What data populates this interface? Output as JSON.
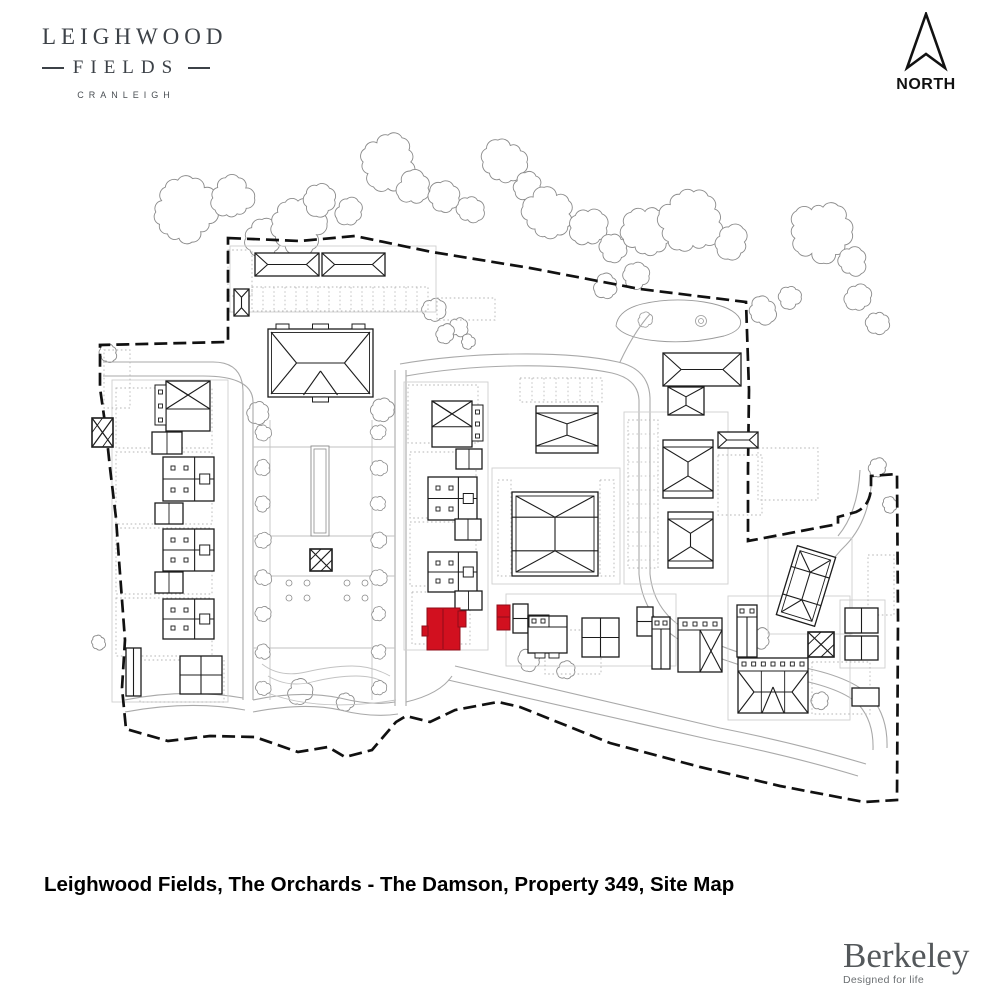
{
  "header": {
    "logo": {
      "line1": "LEIGHWOOD",
      "line2": "FIELDS",
      "line3": "CRANLEIGH"
    },
    "north_label": "NORTH"
  },
  "footer": {
    "caption": "Leighwood Fields, The Orchards - The Damson, Property 349, Site Map",
    "brand": "Berkeley",
    "brand_tagline": "Designed for life"
  },
  "colors": {
    "highlight": "#d2101f",
    "highlight_edge": "#8f0d18",
    "line": "#1c1c1c",
    "road": "#a9a9a9",
    "dots": "#b5b5b5",
    "plot": "#cfcfcf",
    "tree": "#8a8a8a",
    "boundary": "#111111"
  },
  "site_plan": {
    "boundary": "M228,238 L300,241 L355,236 L432,252 L530,268 L640,289 L746,302 L749,390 L748,468 L748,541 L838,524 L838,517 L856,512 Q870,506 871,488 L871,476 L897,474 L898,620 L897,800 L864,802 L780,786 L700,767 L610,743 L520,707 L498,702 L455,710 L430,722 L406,716 L396,722 L372,750 L345,757 L328,747 L298,752 L255,737 L210,736 L168,741 L126,729 L122,688 L125,640 L119,560 L116,518 L110,468 L106,430 L100,388 L100,345 L228,342 Z",
    "roads": [
      "M103,362 H213 Q243,362 243,392 V700",
      "M103,376 H203 Q253,376 253,402 V700",
      "M395,370 V706",
      "M406,370 V706",
      "M400,364 C470,352 565,350 618,362 Q649,369 650,398 V574",
      "M406,376 C475,364 560,362 612,373 Q638,379 639,400 V574",
      "M650,574 Q654,614 692,633 Q742,658 795,666 Q852,676 872,698 Q888,718 887,748",
      "M639,574 Q643,620 686,644 Q738,668 790,678 Q843,688 859,705 Q874,722 873,750",
      "M125,700 Q185,688 243,698",
      "M125,712 Q190,700 245,710",
      "M253,700 Q300,690 340,698 Q372,706 395,702",
      "M253,712 Q305,702 340,710 Q372,718 398,714",
      "M406,702 Q440,694 452,676",
      "M455,666 Q600,700 720,728 Q800,744 866,764",
      "M448,680 Q595,714 712,740 Q792,756 858,776",
      "M872,476 Q870,520 846,545 Q824,566 820,590",
      "M860,470 Q858,512 838,536",
      "M620,362 Q634,332 650,314"
    ],
    "trees": [
      [
        185,
        212,
        30
      ],
      [
        232,
        198,
        20
      ],
      [
        262,
        238,
        16
      ],
      [
        298,
        224,
        26
      ],
      [
        320,
        200,
        15
      ],
      [
        350,
        212,
        13
      ],
      [
        388,
        162,
        26
      ],
      [
        414,
        188,
        15
      ],
      [
        444,
        198,
        14
      ],
      [
        470,
        210,
        12
      ],
      [
        505,
        162,
        20
      ],
      [
        528,
        186,
        13
      ],
      [
        548,
        214,
        24
      ],
      [
        588,
        228,
        17
      ],
      [
        614,
        248,
        13
      ],
      [
        648,
        232,
        24
      ],
      [
        690,
        222,
        28
      ],
      [
        732,
        242,
        15
      ],
      [
        762,
        310,
        13
      ],
      [
        790,
        297,
        11
      ],
      [
        820,
        232,
        28
      ],
      [
        852,
        262,
        13
      ],
      [
        858,
        298,
        13
      ],
      [
        878,
        322,
        10
      ],
      [
        606,
        286,
        11
      ],
      [
        636,
        276,
        11
      ],
      [
        433,
        310,
        11
      ],
      [
        458,
        327,
        9
      ],
      [
        108,
        353,
        8
      ],
      [
        258,
        412,
        10
      ],
      [
        383,
        410,
        10
      ],
      [
        300,
        692,
        11
      ],
      [
        345,
        701,
        8
      ],
      [
        98,
        642,
        7
      ],
      [
        530,
        660,
        10
      ],
      [
        566,
        670,
        8
      ],
      [
        760,
        638,
        9
      ],
      [
        820,
        701,
        8
      ],
      [
        445,
        334,
        9
      ],
      [
        468,
        342,
        7
      ],
      [
        878,
        468,
        8
      ],
      [
        890,
        505,
        7
      ]
    ],
    "pond": {
      "outer": "M616,326 Q618,310 642,304 Q672,297 704,302 Q734,307 740,319 Q744,330 724,336 Q690,344 658,341 Q624,338 616,326 Z",
      "circles": [
        [
          701,
          321,
          2.5
        ],
        [
          701,
          321,
          5.5
        ]
      ],
      "blob": [
        645,
        320,
        7
      ]
    },
    "plots": [
      [
        112,
        380,
        116,
        322
      ],
      [
        404,
        382,
        84,
        268
      ],
      [
        492,
        468,
        128,
        116
      ],
      [
        624,
        412,
        104,
        172
      ],
      [
        506,
        594,
        170,
        72
      ],
      [
        728,
        596,
        122,
        124
      ],
      [
        230,
        246,
        206,
        66
      ],
      [
        768,
        538,
        84,
        96
      ],
      [
        840,
        600,
        45,
        68
      ]
    ],
    "dotted_areas": [
      {
        "x": 116,
        "y": 388,
        "w": 96,
        "h": 60
      },
      {
        "x": 116,
        "y": 452,
        "w": 96,
        "h": 72
      },
      {
        "x": 116,
        "y": 528,
        "w": 96,
        "h": 66
      },
      {
        "x": 116,
        "y": 598,
        "w": 96,
        "h": 58
      },
      {
        "x": 140,
        "y": 660,
        "w": 84,
        "h": 42
      },
      {
        "x": 252,
        "y": 287,
        "w": 176,
        "h": 24,
        "bays": 11
      },
      {
        "x": 408,
        "y": 385,
        "w": 70,
        "h": 58
      },
      {
        "x": 410,
        "y": 452,
        "w": 66,
        "h": 66
      },
      {
        "x": 410,
        "y": 522,
        "w": 66,
        "h": 64
      },
      {
        "x": 412,
        "y": 592,
        "w": 58,
        "h": 52
      },
      {
        "x": 520,
        "y": 378,
        "w": 82,
        "h": 24,
        "bays": 12
      },
      {
        "x": 498,
        "y": 480,
        "w": 13,
        "h": 96
      },
      {
        "x": 600,
        "y": 480,
        "w": 14,
        "h": 96
      },
      {
        "x": 628,
        "y": 420,
        "w": 30,
        "h": 148,
        "baysH": 14
      },
      {
        "x": 545,
        "y": 630,
        "w": 56,
        "h": 44
      },
      {
        "x": 718,
        "y": 455,
        "w": 44,
        "h": 60
      },
      {
        "x": 758,
        "y": 448,
        "w": 60,
        "h": 52
      },
      {
        "x": 812,
        "y": 662,
        "w": 58,
        "h": 52
      },
      {
        "x": 868,
        "y": 555,
        "w": 26,
        "h": 60
      },
      {
        "x": 228,
        "y": 250,
        "w": 24,
        "h": 46
      },
      {
        "x": 104,
        "y": 350,
        "w": 26,
        "h": 58
      },
      {
        "x": 437,
        "y": 298,
        "w": 58,
        "h": 22
      }
    ],
    "garden": {
      "avenue_x": [
        263,
        379
      ],
      "avenue_y": [
        432,
        468,
        504,
        540,
        578,
        614,
        652,
        688
      ],
      "avenue_r": 7,
      "strip_outer": [
        311,
        446,
        18,
        90
      ],
      "strip_inner": [
        314,
        449,
        12,
        84
      ],
      "parterre": [
        [
          289,
          583
        ],
        [
          307,
          583
        ],
        [
          347,
          583
        ],
        [
          365,
          583
        ],
        [
          289,
          598
        ],
        [
          307,
          598
        ],
        [
          347,
          598
        ],
        [
          365,
          598
        ]
      ],
      "paths": [
        "M270,420 V700",
        "M372,420 V700",
        "M253,447 H395",
        "M253,536 H395",
        "M253,576 H395",
        "M253,648 H395",
        "M262,664 q18,14 44,8 t46,-6 t38,10",
        "M268,676 q20,12 44,6 t44,-6 t30,8",
        "M256,688 Q310,714 396,700"
      ]
    },
    "buildings": [
      {
        "t": "hipH",
        "x": 255,
        "y": 253,
        "w": 64,
        "h": 23
      },
      {
        "t": "hipH",
        "x": 322,
        "y": 253,
        "w": 63,
        "h": 23
      },
      {
        "t": "hipV",
        "x": 234,
        "y": 289,
        "w": 15,
        "h": 27
      },
      {
        "t": "manor",
        "x": 268,
        "y": 329,
        "w": 105,
        "h": 68
      },
      {
        "t": "hipH",
        "x": 663,
        "y": 353,
        "w": 78,
        "h": 33
      },
      {
        "t": "hipV",
        "x": 668,
        "y": 387,
        "w": 36,
        "h": 28
      },
      {
        "t": "xtop",
        "x": 166,
        "y": 381,
        "w": 44,
        "h": 50,
        "side": "l"
      },
      {
        "t": "terrace",
        "x": 163,
        "y": 457,
        "w": 51,
        "h": 44
      },
      {
        "t": "terrace",
        "x": 163,
        "y": 529,
        "w": 51,
        "h": 42
      },
      {
        "t": "terrace",
        "x": 163,
        "y": 599,
        "w": 51,
        "h": 40
      },
      {
        "t": "grid2",
        "x": 180,
        "y": 656,
        "w": 42,
        "h": 38
      },
      {
        "t": "plain",
        "x": 126,
        "y": 648,
        "w": 15,
        "h": 48,
        "vline": true
      },
      {
        "t": "garage",
        "x": 152,
        "y": 432,
        "w": 30,
        "h": 22
      },
      {
        "t": "garage",
        "x": 155,
        "y": 503,
        "w": 28,
        "h": 21
      },
      {
        "t": "garage",
        "x": 155,
        "y": 572,
        "w": 28,
        "h": 21
      },
      {
        "t": "xtop",
        "x": 432,
        "y": 401,
        "w": 40,
        "h": 46,
        "side": "r"
      },
      {
        "t": "terrace",
        "x": 428,
        "y": 477,
        "w": 49,
        "h": 43
      },
      {
        "t": "terrace",
        "x": 428,
        "y": 552,
        "w": 49,
        "h": 40
      },
      {
        "t": "garage",
        "x": 456,
        "y": 449,
        "w": 26,
        "h": 20
      },
      {
        "t": "garage",
        "x": 455,
        "y": 519,
        "w": 26,
        "h": 21
      },
      {
        "t": "garage",
        "x": 455,
        "y": 591,
        "w": 27,
        "h": 19
      },
      {
        "t": "apt",
        "x": 536,
        "y": 406,
        "w": 62,
        "h": 47
      },
      {
        "t": "court",
        "x": 512,
        "y": 492,
        "w": 86,
        "h": 84
      },
      {
        "t": "plain",
        "x": 513,
        "y": 604,
        "w": 15,
        "h": 29,
        "hline": 0.5
      },
      {
        "t": "shopA",
        "x": 528,
        "y": 616,
        "w": 39,
        "h": 37
      },
      {
        "t": "grid2",
        "x": 582,
        "y": 618,
        "w": 37,
        "h": 39
      },
      {
        "t": "plain",
        "x": 637,
        "y": 607,
        "w": 16,
        "h": 29,
        "hline": 0.5
      },
      {
        "t": "tallD",
        "x": 652,
        "y": 617,
        "w": 18,
        "h": 52
      },
      {
        "t": "semiX",
        "x": 678,
        "y": 618,
        "w": 44,
        "h": 54
      },
      {
        "t": "apt",
        "x": 663,
        "y": 440,
        "w": 50,
        "h": 58
      },
      {
        "t": "apt",
        "x": 668,
        "y": 512,
        "w": 45,
        "h": 56
      },
      {
        "t": "hipH",
        "x": 718,
        "y": 432,
        "w": 40,
        "h": 16
      },
      {
        "t": "court",
        "x": 786,
        "y": 550,
        "w": 40,
        "h": 72,
        "rot": 17
      },
      {
        "t": "hatch",
        "x": 92,
        "y": 418,
        "w": 21,
        "h": 29
      },
      {
        "t": "hatch",
        "x": 310,
        "y": 549,
        "w": 22,
        "h": 22
      },
      {
        "t": "hatch",
        "x": 808,
        "y": 632,
        "w": 26,
        "h": 25
      },
      {
        "t": "tallD",
        "x": 737,
        "y": 605,
        "w": 20,
        "h": 52
      },
      {
        "t": "terraceHip",
        "x": 738,
        "y": 658,
        "w": 70,
        "h": 55
      },
      {
        "t": "plain",
        "x": 845,
        "y": 608,
        "w": 33,
        "h": 25,
        "vline": true
      },
      {
        "t": "plain",
        "x": 845,
        "y": 636,
        "w": 33,
        "h": 24,
        "vline": true
      },
      {
        "t": "plain",
        "x": 852,
        "y": 688,
        "w": 27,
        "h": 18
      }
    ],
    "highlight": {
      "label": "Property 349",
      "rects": [
        [
          427,
          608,
          33,
          42
        ],
        [
          458,
          611,
          8,
          16
        ],
        [
          422,
          626,
          6,
          10
        ],
        [
          497,
          605,
          13,
          25
        ]
      ],
      "lines": [
        [
          443,
          609,
          443,
          649
        ],
        [
          497,
          617,
          510,
          617
        ]
      ]
    }
  }
}
